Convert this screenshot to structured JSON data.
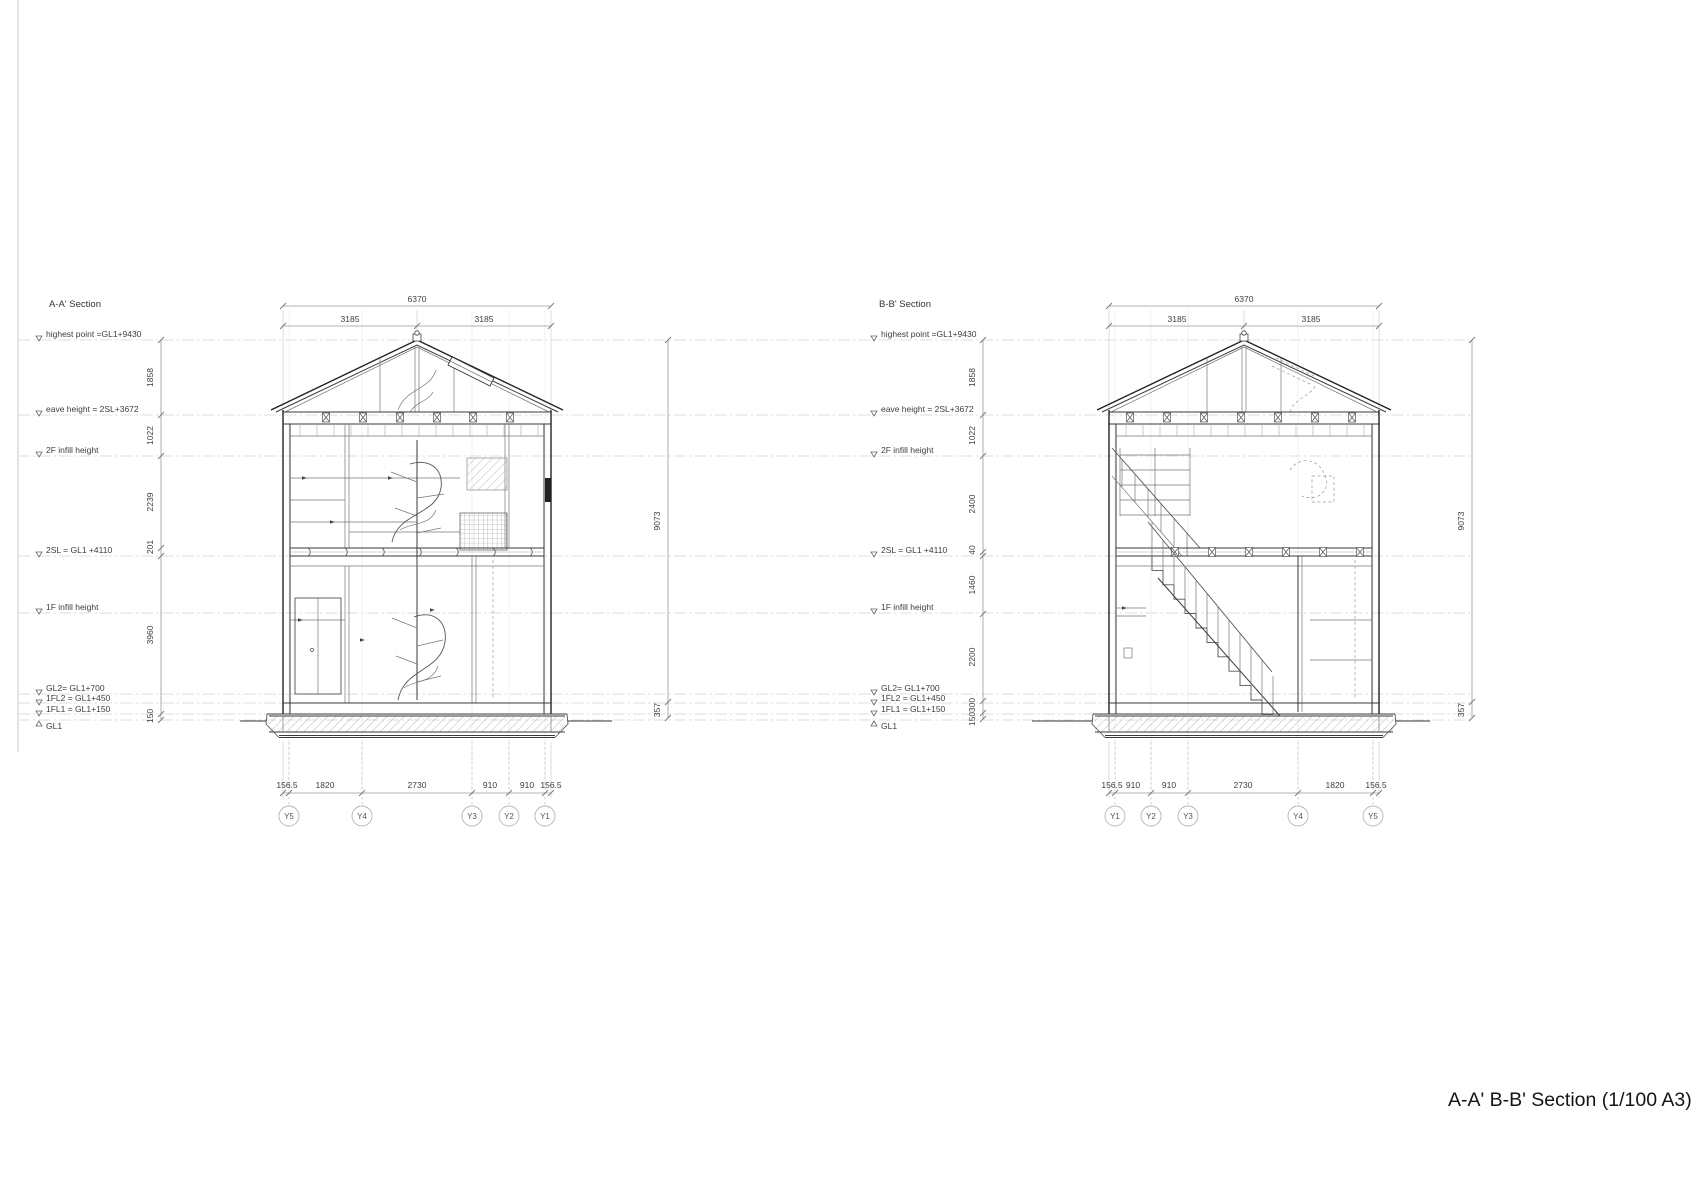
{
  "title": "A-A' B-B' Section (1/100 A3)",
  "colors": {
    "line_dark": "#222222",
    "line_light": "#9a9a9a",
    "text": "#3d3d3d"
  },
  "sections": {
    "a": {
      "name": "A-A' Section",
      "levels": [
        "highest point =GL1+9430",
        "eave height = 2SL+3672",
        "2F infill height",
        "2SL = GL1 +4110",
        "1F infill height",
        "GL2= GL1+700",
        "1FL2 = GL1+450",
        "1FL1 = GL1+150",
        "GL1"
      ],
      "dims_top": {
        "total": "6370",
        "half_left": "3185",
        "half_right": "3185"
      },
      "dims_left": [
        "1858",
        "1022",
        "2239",
        "201",
        "3960",
        "150"
      ],
      "dims_right": [
        "9073",
        "357"
      ],
      "dims_bottom": [
        "156.5",
        "1820",
        "2730",
        "910",
        "910",
        "156.5"
      ],
      "grids": [
        "Y5",
        "Y4",
        "Y3",
        "Y2",
        "Y1"
      ]
    },
    "b": {
      "name": "B-B' Section",
      "levels": [
        "highest point =GL1+9430",
        "eave height = 2SL+3672",
        "2F infill height",
        "2SL = GL1 +4110",
        "1F infill height",
        "GL2= GL1+700",
        "1FL2 = GL1+450",
        "1FL1 = GL1+150",
        "GL1"
      ],
      "dims_top": {
        "total": "6370",
        "half_left": "3185",
        "half_right": "3185"
      },
      "dims_left": [
        "1858",
        "1022",
        "2400",
        "40",
        "1460",
        "2200",
        "300",
        "150"
      ],
      "dims_right": [
        "9073",
        "357"
      ],
      "dims_bottom": [
        "156.5",
        "910",
        "910",
        "2730",
        "1820",
        "156.5"
      ],
      "grids": [
        "Y1",
        "Y2",
        "Y3",
        "Y4",
        "Y5"
      ]
    }
  }
}
